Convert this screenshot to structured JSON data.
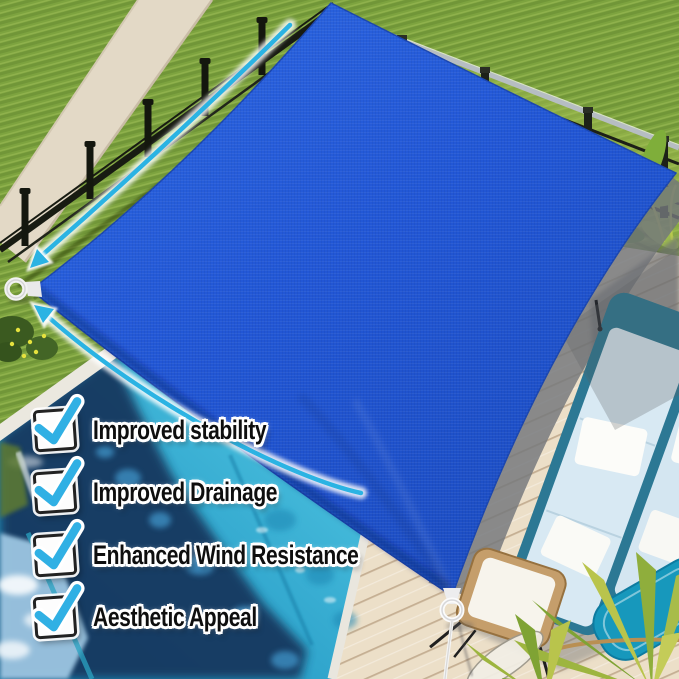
{
  "features": {
    "items": [
      {
        "label": "Improved stability",
        "checked": true
      },
      {
        "label": "Improved Drainage",
        "checked": true
      },
      {
        "label": "Enhanced Wind Resistance",
        "checked": true
      },
      {
        "label": "Aesthetic Appeal",
        "checked": true
      }
    ]
  },
  "annotations": {
    "arrows": [
      {
        "name": "curved-arrow-upper-left-edge",
        "points_to": "left corner ring"
      },
      {
        "name": "curved-arrow-lower-left-edge",
        "points_to": "left corner ring"
      }
    ],
    "hardware": [
      {
        "name": "corner-ring-left"
      },
      {
        "name": "corner-ring-bottom"
      },
      {
        "name": "tie-cord-bottom"
      }
    ]
  },
  "colors": {
    "sail_blue": "#2459d4",
    "arrow_cyan": "#2bb3e3",
    "check_cyan": "#30b0e4",
    "text_black": "#0e0e0e",
    "outline_white": "#ffffff",
    "grass_green": "#7da33f",
    "pool_turquoise": "#31a6cd",
    "pool_deep_navy": "#14395f",
    "deck_cream": "#ecdfc8",
    "deck_shadow_gray": "#73767b",
    "chair_teal": "#2c7894",
    "cushion_blue": "#d8e9f3"
  }
}
